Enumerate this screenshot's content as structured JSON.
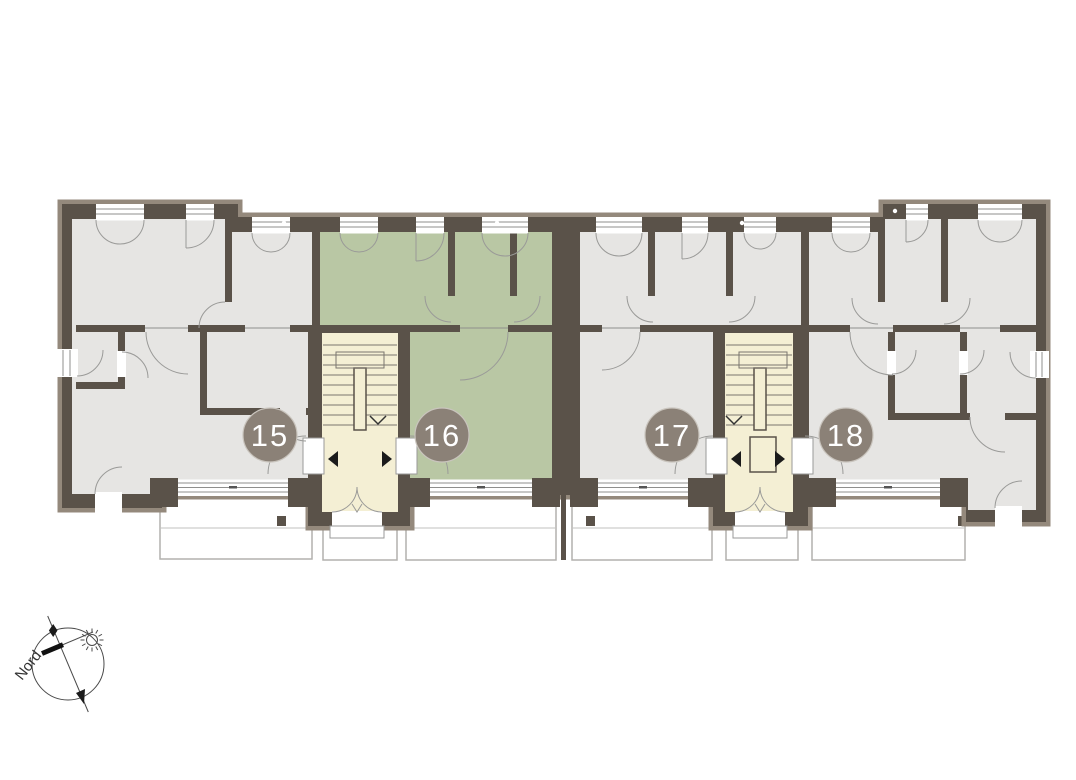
{
  "plan": {
    "units": [
      {
        "label": "15",
        "highlighted": false
      },
      {
        "label": "16",
        "highlighted": true
      },
      {
        "label": "17",
        "highlighted": false
      },
      {
        "label": "18",
        "highlighted": false
      }
    ],
    "compass_label": "Nord"
  },
  "colors": {
    "wall": "#5a5249",
    "wall-outer": "#94897c",
    "room": "#e6e5e3",
    "highlight": "#b9c7a4",
    "stairwell": "#f4efd4",
    "badge": "#8b8177",
    "badge-text": "#ffffff",
    "line": "#9a9a98",
    "terrace": "#b2b1ae"
  }
}
